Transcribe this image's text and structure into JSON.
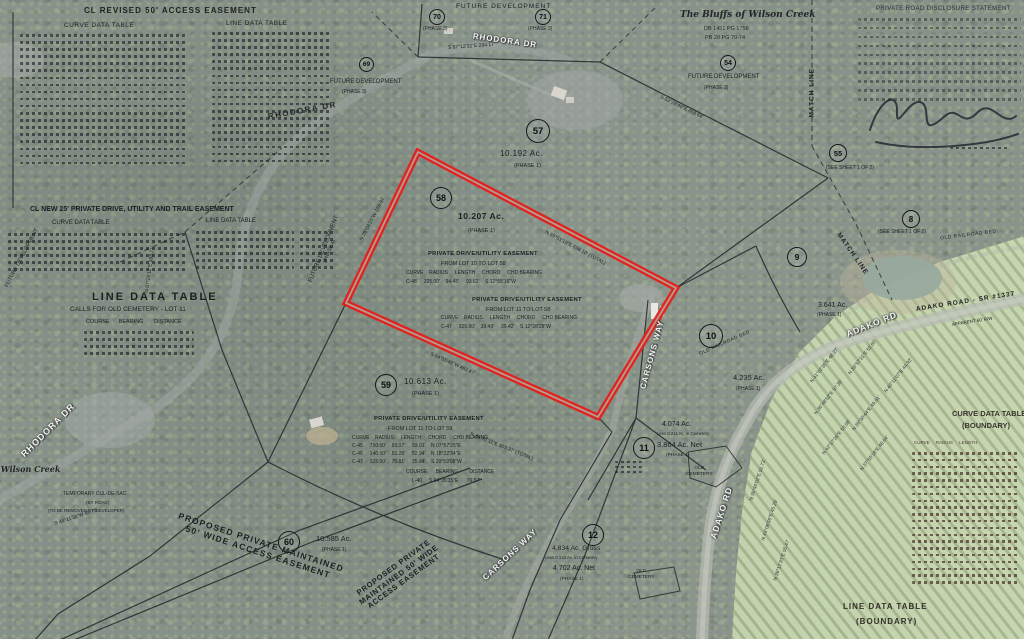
{
  "colors": {
    "highlight": "#e51f1b",
    "inner_gap": "#aab4a6",
    "boundary_line": "#22262a"
  },
  "titles": {
    "revised_access": "CL REVISED 50' ACCESS EASEMENT",
    "curve_data_table": "CURVE DATA TABLE",
    "line_data_table": "LINE DATA TABLE",
    "new_25_easement": "CL NEW 25' PRIVATE DRIVE, UTILITY AND TRAIL EASEMENT",
    "line_data_table_big": "LINE DATA TABLE",
    "cemetery_calls": "CALLS FOR OLD CEMETERY - LOT 11",
    "course_bearing_distance": "COURSE      BEARING       DISTANCE",
    "curve_table_boundary_1": "CURVE DATA TABLE",
    "curve_table_boundary_2": "(BOUNDARY)",
    "curve_boundary_cols": "CURVE     RADIUS     LENGTH",
    "line_table_boundary_1": "LINE DATA TABLE",
    "line_table_boundary_2": "(BOUNDARY)"
  },
  "subdivision": {
    "name": "The Bluffs of Wilson Creek",
    "deed": "DB 1451 PG 1756",
    "plat": "PB 20 PG 70-74"
  },
  "disclosure": {
    "title": "PRIVATE ROAD DISCLOSURE STATEMENT"
  },
  "roads": {
    "rhodora_top": "RHODORA DR",
    "rhodora_curve": "RHODORA DR",
    "rhodora_left": "RHODORA DR",
    "adako_1": "ADAKO RD",
    "adako_2": "ADAKO RD",
    "adako_road_sr": "ADAKO ROAD  -  SR #1337",
    "apparent_rw": "APPARENT 60' R/W",
    "carsons_1": "CARSONS WAY",
    "carsons_2": "CARSONS WAY"
  },
  "area": {
    "future_development": "FUTURE DEVELOPMENT",
    "phase1": "(PHASE 1)",
    "phase3": "(PHASE 3)",
    "phase4": "(PHASE 4)",
    "match_line": "MATCH LINE",
    "see_sheet": "(SEE SHEET 1 OF 2)",
    "old_railroad_bed": "OLD RAILROAD BED",
    "old_cemetery_1": "OLD",
    "old_cemetery_2": "CEMETERY",
    "temp_culdesac_1": "TEMPORARY CUL-DE-SAC",
    "temp_culdesac_2": "(BY ROAD)",
    "temp_culdesac_3": "(TO BE REMOVED BY DEVELOPER)",
    "proposed_easement_1a": "PROPOSED PRIVATE MAINTAINED",
    "proposed_easement_1b": "50' WIDE ACCESS EASEMENT",
    "proposed_easement_2a": "PROPOSED PRIVATE",
    "proposed_easement_2b": "MAINTAINED 50' WIDE",
    "proposed_easement_2c": "ACCESS EASEMENT"
  },
  "lots": {
    "lot57": {
      "num": "57",
      "acres": "10.192 Ac.",
      "phase": "(PHASE 1)"
    },
    "lot58": {
      "num": "58",
      "acres": "10.207 Ac.",
      "phase": "(PHASE 1)"
    },
    "lot59": {
      "num": "59",
      "acres": "10.613 Ac.",
      "phase": "(PHASE 1)"
    },
    "lot60": {
      "num": "60",
      "acres": "10.585 Ac.",
      "phase": "(PHASE 1)"
    },
    "lot69": {
      "num": "69"
    },
    "lot70": {
      "num": "70",
      "phase": "(PHASE 3)"
    },
    "lot71": {
      "num": "71",
      "phase": "(PHASE 3)"
    },
    "lot54": {
      "num": "54"
    },
    "lot55": {
      "num": "55"
    },
    "lot8": {
      "num": "8"
    },
    "lot9": {
      "num": "9",
      "acres": "3.641 Ac.",
      "phase": "(PHASE 1)"
    },
    "lot10": {
      "num": "10",
      "acres": "4.235 Ac.",
      "phase": "(PHASE 1)"
    },
    "lot11": {
      "num": "11",
      "gross": "4.074 Ac.",
      "less": "Less 0.211 Ac. in Cemetery",
      "net": "3.864 Ac. Net",
      "phase": "(PHASE 1)"
    },
    "lot12": {
      "num": "12",
      "gross": "4.834 Ac. Gross",
      "less": "Less 0.132 Ac. in Cemetery",
      "net": "4.702 Ac. Net",
      "phase": "(PHASE 1)"
    }
  },
  "easements": {
    "lot10_58": {
      "title": "PRIVATE DRIVE/UTILITY EASEMENT",
      "from": "FROM LOT 10 TO LOT 58",
      "cols": "CURVE    RADIUS     LENGTH     CHORD     CHD BEARING",
      "row1": "C-48     325.00'    94.45'     93.62'    S 12°55'16\"W"
    },
    "lot11_58": {
      "title": "PRIVATE DRIVE/UTILITY EASEMENT",
      "from": "FROM LOT 11 TO LOT 58",
      "cols": "CURVE    RADIUS     LENGTH     CHORD     CHD BEARING",
      "row1": "C-47     325.00'    39.49'     39.42'    S 12°28'28\"W"
    },
    "lot11_59": {
      "title": "PRIVATE DRIVE/UTILITY EASEMENT",
      "from": "FROM LOT 11 TO LOT 59",
      "cols": "CURVE    RADIUS     LENGTH     CHORD     CHD BEARING",
      "row1": "C-45     750.00'    93.07'     93.01'    N 07°57'25\"E",
      "row2": "C-46     140.00'    53.26'     52.94'    N 18°22'34\"E",
      "row3": "C-47     325.00'    75.81'     75.64'    S 20°59'08\"W",
      "cols2": "COURSE      BEARING        DISTANCE",
      "row4": "L-40     S 64°35'35\"E      76.57'"
    }
  },
  "bearings": [
    "N 59°51'19\"E  598.10' (TOTAL)",
    "N 29°04'21\"W  188.97'",
    "S 84°55'45\"W  462.47'",
    "N 84°51'11\"E  603.37' (TOTAL)",
    "S 53°26'40\"E  458.64'",
    "S 87°12'32\"E  294.17'",
    "N 07°28'11\"E  188.71'",
    "S 48°11'38\"W  85.75'"
  ],
  "field_bearings": [
    "N 41°02'35\"E 48.27'",
    "N 38°57'21\"E 52.60'",
    "N 40°11'07\"E 44.92'",
    "N 36°48'52\"E 57.35'",
    "N 39°30'44\"E 49.81'",
    "N 42°17'26\"E 53.08'",
    "N 37°55'18\"E 46.64'",
    "N 35°40'02\"E 51.73'",
    "N 43°08'56\"E 45.29'",
    "N 39°12'33\"E 55.47'"
  ]
}
